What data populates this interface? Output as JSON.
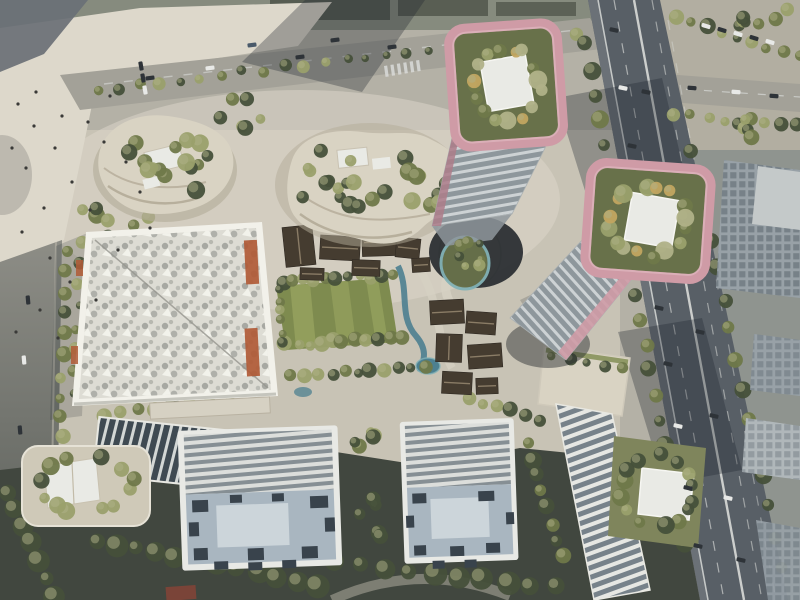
{
  "meta": {
    "title": "Aerial rendering of mixed-use development masterplan",
    "width": 800,
    "height": 600
  },
  "palette": {
    "base": "#b4b1a6",
    "topband": "#868b7e",
    "topblock": "#4e5349",
    "plaza": "#ddd8cb",
    "plaza_dim": "#c8c3b5",
    "corner_wedge": "#6a7076",
    "canopy_gray": "#b9b6ac",
    "road": "#a3a198",
    "lane": "#d9dbd8",
    "leftroad_top": "#8d8d86",
    "leftroad_bottom": "#595d58",
    "rightside_top": "#b2aea1",
    "rightside_bottom": "#8f948f",
    "highway": "#585f66",
    "highway_edge": "#6e747a",
    "shadow": "rgba(30,38,46,0.32)",
    "shadow_soft": "rgba(30,38,46,0.18)",
    "shadow_deep": "#41473f",
    "lawn": "#7e8b4f",
    "lawn_light": "#97a35f",
    "water": "#4d8090",
    "water_light": "#82b2b6",
    "court": "#cfc9b8",
    "path": "#d6d1c3",
    "cream": "#d9d3c3",
    "cream_dark": "#b3ab98",
    "cream_line": "#a89f8b",
    "pad": "#e9eae5",
    "pink": "#cf9ba6",
    "pink_light": "#e3bcc4",
    "pink_dark": "#ad7c8a",
    "garden": "#68714a",
    "garden2": "#7f855c",
    "band_light": "#cdd2d4",
    "band_dark": "#8e979c",
    "hall_border": "#f2f1ea",
    "hall_roof": "#dddcd4",
    "hall_dot": "#a7a8a2",
    "hall_seam": "#96968f",
    "hall_white": "#f4f4ee",
    "orange": "#b05a36",
    "rib_light": "#dcdedb",
    "rib_dark": "#868f94",
    "ribw_light": "#d3d7d5",
    "ribw_dark": "#3f4a52",
    "ribe_light": "#e6e7e3",
    "ribe_dark": "#77828a",
    "deck": "#a9b6c0",
    "deck_panel": "#ccd5da",
    "deck_unit": "#39434c",
    "slab_edge": "#e8e9e5",
    "pav_roof": "#453c30",
    "pav_ridge": "#8a7c66",
    "office": "#98a1a7",
    "office_roof": "#c4c9c9",
    "office_win": "#5c676f",
    "office_lt": "#b0b7ba",
    "red_roof": "#7a4438",
    "void_dark": "#23282c",
    "tree_dark": "#46503a",
    "tree_mid": "#6f7849",
    "tree_light": "#9aa06b",
    "tree_pale": "#b0b188",
    "tree_yellow": "#c2a560",
    "car_dark": "#2e3338",
    "car_white": "#e8e9e7",
    "car_blue": "#4a5a6a",
    "people": "#3a3a38"
  },
  "scene": {
    "elements": [
      "pink-crown office tower west with rooftop garden and white pad",
      "pink-crown office tower east with rooftop garden and white pad",
      "diagrid-roof exhibition hall with orange fins",
      "terraced retail pod west",
      "terraced retail pod north",
      "heritage pavilion cluster north",
      "heritage pavilion cluster east",
      "central lawn with tree rows and winding stream",
      "sunken circular court with garden",
      "residential slab building west",
      "residential slab building east",
      "finned parking ribbon west",
      "finned parking ribbon east with rooftop garden",
      "corner garden building southwest",
      "elevated highway with traffic",
      "tree-lined boulevard north",
      "pedestrian plaza west",
      "office blocks along east edge"
    ]
  },
  "decor": {
    "treeClusters": [
      {
        "cx": 165,
        "cy": 166,
        "rx": 50,
        "ry": 32,
        "n": 15,
        "r": 7,
        "layer": "mid"
      },
      {
        "cx": 360,
        "cy": 180,
        "rx": 68,
        "ry": 36,
        "n": 20,
        "r": 7,
        "layer": "mid"
      },
      {
        "cx": 448,
        "cy": 200,
        "rx": 20,
        "ry": 22,
        "n": 5,
        "r": 6,
        "layer": "mid"
      },
      {
        "cx": 116,
        "cy": 222,
        "rx": 52,
        "ry": 20,
        "n": 8,
        "r": 7
      },
      {
        "cx": 250,
        "cy": 112,
        "rx": 36,
        "ry": 18,
        "n": 6,
        "r": 6
      },
      {
        "cx": 186,
        "cy": 136,
        "rx": 20,
        "ry": 12,
        "n": 4,
        "r": 6
      },
      {
        "type": "ring",
        "cx": 506,
        "cy": 84,
        "rx": 34,
        "ry": 36,
        "n": 16,
        "r": 7,
        "layer": "top",
        "colors": [
          "tree_mid",
          "tree_light",
          "tree_yellow",
          "tree_pale"
        ]
      },
      {
        "type": "ring",
        "cx": 648,
        "cy": 221,
        "rx": 38,
        "ry": 34,
        "n": 16,
        "r": 7,
        "layer": "top",
        "colors": [
          "tree_mid",
          "tree_light",
          "tree_yellow",
          "tree_pale"
        ]
      },
      {
        "type": "ring",
        "cx": 470,
        "cy": 255,
        "rx": 13,
        "ry": 15,
        "n": 7,
        "r": 5,
        "layer": "top"
      },
      {
        "type": "ring",
        "cx": 657,
        "cy": 492,
        "rx": 36,
        "ry": 36,
        "n": 14,
        "r": 7,
        "layer": "mid"
      },
      {
        "type": "ring",
        "cx": 86,
        "cy": 484,
        "rx": 46,
        "ry": 28,
        "n": 12,
        "r": 7,
        "layer": "mid"
      },
      {
        "cx": 368,
        "cy": 444,
        "rx": 18,
        "ry": 14,
        "n": 5,
        "r": 6
      },
      {
        "cx": 374,
        "cy": 520,
        "rx": 16,
        "ry": 30,
        "n": 6,
        "r": 7,
        "colors": [
          "tree_dark"
        ]
      },
      {
        "cx": 762,
        "cy": 18,
        "rx": 34,
        "ry": 14,
        "n": 7,
        "r": 6
      },
      {
        "cx": 760,
        "cy": 130,
        "rx": 30,
        "ry": 12,
        "n": 5,
        "r": 6
      }
    ],
    "treeRows": [
      {
        "x1": 98,
        "y1": 90,
        "x2": 574,
        "y2": 32,
        "n": 24,
        "r": 5
      },
      {
        "x1": 66,
        "y1": 252,
        "x2": 60,
        "y2": 458,
        "n": 11,
        "r": 6
      },
      {
        "x1": 80,
        "y1": 244,
        "x2": 74,
        "y2": 392,
        "n": 8,
        "r": 5
      },
      {
        "x1": 102,
        "y1": 414,
        "x2": 228,
        "y2": 402,
        "n": 8,
        "r": 6
      },
      {
        "x1": 585,
        "y1": 44,
        "x2": 686,
        "y2": 546,
        "n": 21,
        "r": 7,
        "colors": [
          "tree_dark",
          "tree_mid"
        ]
      },
      {
        "x1": 692,
        "y1": 150,
        "x2": 780,
        "y2": 566,
        "n": 15,
        "r": 7,
        "colors": [
          "tree_dark",
          "tree_mid"
        ]
      },
      {
        "x1": 282,
        "y1": 282,
        "x2": 392,
        "y2": 275,
        "n": 11,
        "r": 6
      },
      {
        "x1": 286,
        "y1": 345,
        "x2": 400,
        "y2": 338,
        "n": 11,
        "r": 6
      },
      {
        "x1": 292,
        "y1": 376,
        "x2": 424,
        "y2": 366,
        "n": 11,
        "r": 6
      },
      {
        "x1": 278,
        "y1": 290,
        "x2": 282,
        "y2": 342,
        "n": 6,
        "r": 5
      },
      {
        "x1": 676,
        "y1": 18,
        "x2": 798,
        "y2": 56,
        "n": 9,
        "r": 6
      },
      {
        "x1": 672,
        "y1": 114,
        "x2": 798,
        "y2": 126,
        "n": 8,
        "r": 6
      },
      {
        "x1": 528,
        "y1": 442,
        "x2": 562,
        "y2": 556,
        "n": 8,
        "r": 7,
        "colors": [
          "tree_dark",
          "tree_mid"
        ]
      },
      {
        "x1": 552,
        "y1": 358,
        "x2": 622,
        "y2": 368,
        "n": 5,
        "r": 5,
        "layer": "mid"
      },
      {
        "x1": 96,
        "y1": 540,
        "x2": 318,
        "y2": 584,
        "n": 12,
        "r": 9,
        "colors": [
          "tree_dark"
        ]
      },
      {
        "x1": 336,
        "y1": 562,
        "x2": 556,
        "y2": 588,
        "n": 10,
        "r": 9,
        "colors": [
          "tree_dark"
        ]
      },
      {
        "x1": 8,
        "y1": 492,
        "x2": 56,
        "y2": 596,
        "n": 7,
        "r": 9,
        "colors": [
          "tree_dark"
        ]
      },
      {
        "x1": 470,
        "y1": 398,
        "x2": 540,
        "y2": 420,
        "n": 6,
        "r": 6
      }
    ],
    "pavilions": [
      [
        284,
        226,
        30,
        40,
        -6
      ],
      [
        320,
        236,
        40,
        24,
        3
      ],
      [
        362,
        228,
        34,
        28,
        -2
      ],
      [
        352,
        260,
        28,
        16,
        2
      ],
      [
        396,
        238,
        24,
        20,
        6
      ],
      [
        300,
        268,
        24,
        12,
        2
      ],
      [
        412,
        258,
        18,
        14,
        -4
      ],
      [
        430,
        300,
        34,
        24,
        -3
      ],
      [
        466,
        312,
        30,
        22,
        4
      ],
      [
        436,
        334,
        26,
        28,
        2
      ],
      [
        468,
        344,
        34,
        24,
        -4
      ],
      [
        442,
        372,
        30,
        22,
        3
      ],
      [
        476,
        378,
        22,
        16,
        -2
      ]
    ],
    "deckUnits": {
      "slabA": [
        [
          192,
          498,
          16,
          12
        ],
        [
          310,
          498,
          18,
          12
        ],
        [
          192,
          546,
          14,
          12
        ],
        [
          246,
          548,
          16,
          12
        ],
        [
          300,
          548,
          16,
          12
        ],
        [
          230,
          494,
          12,
          8
        ],
        [
          272,
          494,
          12,
          8
        ],
        [
          188,
          520,
          10,
          14
        ],
        [
          324,
          520,
          10,
          14
        ],
        [
          212,
          560,
          14,
          8
        ],
        [
          246,
          562,
          14,
          8
        ],
        [
          280,
          561,
          14,
          8
        ]
      ],
      "slabB": [
        [
          412,
          492,
          14,
          10
        ],
        [
          478,
          492,
          16,
          10
        ],
        [
          412,
          544,
          12,
          10
        ],
        [
          448,
          546,
          14,
          10
        ],
        [
          484,
          544,
          14,
          10
        ],
        [
          405,
          514,
          8,
          12
        ],
        [
          505,
          514,
          8,
          12
        ],
        [
          430,
          560,
          12,
          8
        ],
        [
          462,
          560,
          12,
          8
        ]
      ]
    },
    "crosswalk": {
      "x": 384,
      "y": 66,
      "n": 6,
      "dx": 6.4,
      "dy": -1.1,
      "w": 3.2,
      "h": 11,
      "rot": -8
    },
    "cars": [
      [
        614,
        30,
        12,
        "car_dark"
      ],
      [
        623,
        88,
        12,
        "car_white"
      ],
      [
        632,
        146,
        12,
        "car_dark"
      ],
      [
        641,
        200,
        12,
        "car_dark"
      ],
      [
        650,
        252,
        12,
        "car_white"
      ],
      [
        659,
        308,
        13,
        "car_dark"
      ],
      [
        668,
        364,
        13,
        "car_dark"
      ],
      [
        678,
        426,
        13,
        "car_white"
      ],
      [
        688,
        488,
        13,
        "car_dark"
      ],
      [
        698,
        546,
        13,
        "car_dark"
      ],
      [
        646,
        92,
        12,
        "car_dark"
      ],
      [
        664,
        212,
        12,
        "car_white"
      ],
      [
        700,
        332,
        13,
        "car_dark"
      ],
      [
        714,
        416,
        13,
        "car_dark"
      ],
      [
        728,
        498,
        13,
        "car_white"
      ],
      [
        741,
        560,
        13,
        "car_dark"
      ],
      [
        150,
        78,
        -7,
        "car_dark"
      ],
      [
        210,
        68,
        -7,
        "car_white"
      ],
      [
        300,
        57,
        -7,
        "car_dark"
      ],
      [
        392,
        47,
        -7,
        "car_dark"
      ],
      [
        470,
        39,
        -7,
        "car_white"
      ],
      [
        252,
        45,
        -7,
        "car_blue"
      ],
      [
        335,
        40,
        -7,
        "car_dark"
      ],
      [
        706,
        26,
        18,
        "car_white"
      ],
      [
        722,
        30,
        18,
        "car_dark"
      ],
      [
        738,
        34,
        18,
        "car_white"
      ],
      [
        754,
        38,
        18,
        "car_dark"
      ],
      [
        770,
        42,
        18,
        "car_white"
      ],
      [
        692,
        88,
        4,
        "car_dark"
      ],
      [
        736,
        92,
        4,
        "car_white"
      ],
      [
        774,
        96,
        4,
        "car_dark"
      ],
      [
        141,
        66,
        80,
        "car_dark"
      ],
      [
        143,
        78,
        80,
        "car_dark"
      ],
      [
        145,
        90,
        80,
        "car_white"
      ],
      [
        28,
        300,
        85,
        "car_dark"
      ],
      [
        24,
        360,
        85,
        "car_white"
      ],
      [
        20,
        430,
        85,
        "car_dark"
      ]
    ],
    "people": [
      [
        18,
        104
      ],
      [
        34,
        126
      ],
      [
        55,
        148
      ],
      [
        26,
        168
      ],
      [
        72,
        182
      ],
      [
        44,
        208
      ],
      [
        88,
        122
      ],
      [
        110,
        96
      ],
      [
        62,
        116
      ],
      [
        22,
        232
      ],
      [
        50,
        258
      ],
      [
        104,
        142
      ],
      [
        126,
        162
      ],
      [
        90,
        210
      ],
      [
        140,
        192
      ],
      [
        36,
        92
      ],
      [
        12,
        148
      ],
      [
        150,
        228
      ],
      [
        118,
        250
      ],
      [
        70,
        282
      ],
      [
        40,
        310
      ],
      [
        96,
        300
      ],
      [
        16,
        332
      ],
      [
        58,
        338
      ]
    ]
  }
}
